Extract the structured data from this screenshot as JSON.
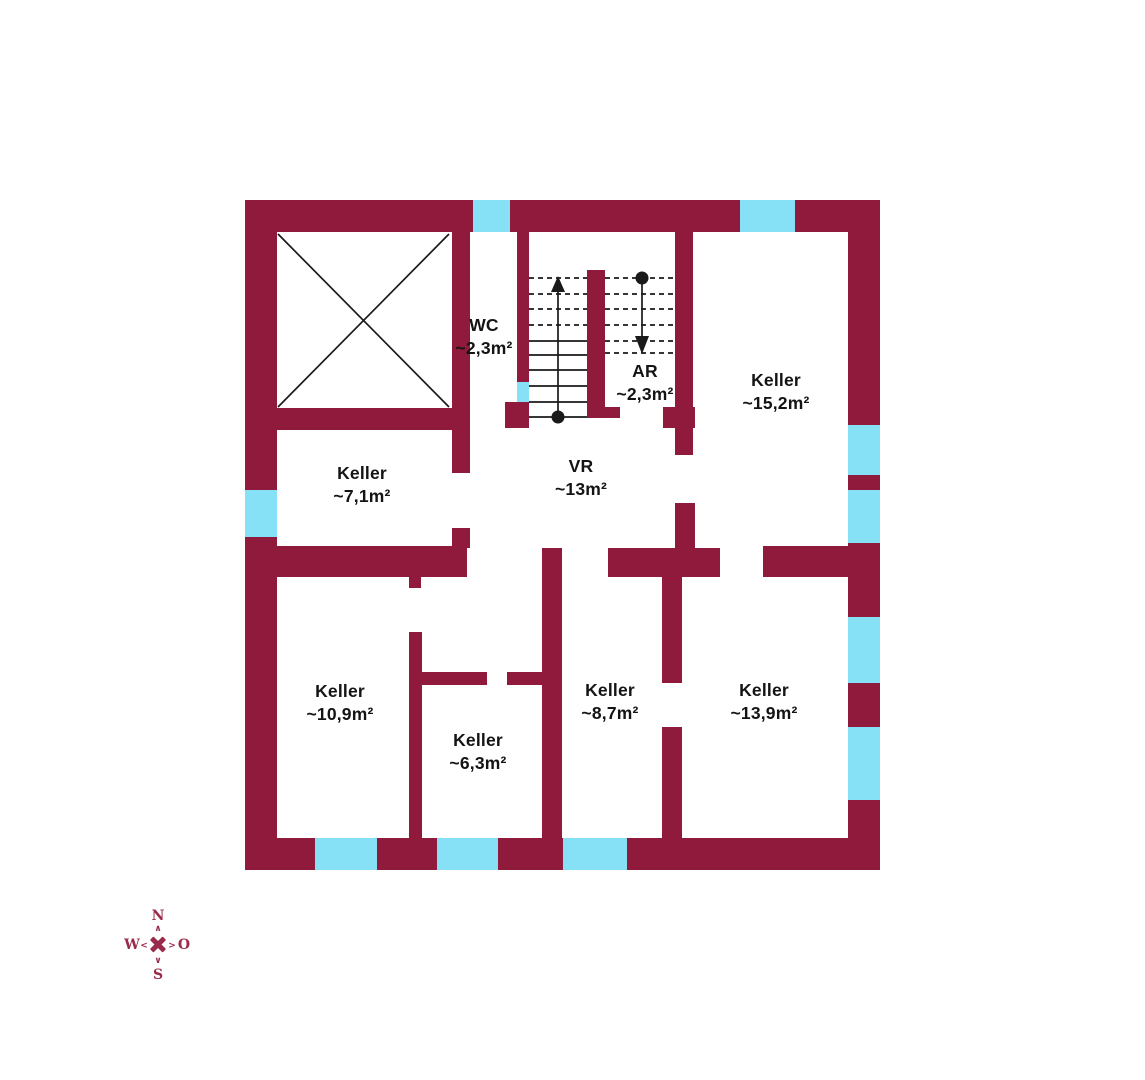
{
  "colors": {
    "wall": "#8f1a3b",
    "window": "#87e1f6",
    "line": "#1a1a1a",
    "compass": "#9b2b4b",
    "background": "#ffffff",
    "text": "#141414"
  },
  "rooms": [
    {
      "id": "wc",
      "name": "WC",
      "area": "~2,3m²",
      "cx": 484,
      "cy": 337
    },
    {
      "id": "ar",
      "name": "AR",
      "area": "~2,3m²",
      "cx": 645,
      "cy": 383
    },
    {
      "id": "keller-152",
      "name": "Keller",
      "area": "~15,2m²",
      "cx": 776,
      "cy": 392
    },
    {
      "id": "keller-71",
      "name": "Keller",
      "area": "~7,1m²",
      "cx": 362,
      "cy": 485
    },
    {
      "id": "vr",
      "name": "VR",
      "area": "~13m²",
      "cx": 581,
      "cy": 478
    },
    {
      "id": "keller-109",
      "name": "Keller",
      "area": "~10,9m²",
      "cx": 340,
      "cy": 703
    },
    {
      "id": "keller-63",
      "name": "Keller",
      "area": "~6,3m²",
      "cx": 478,
      "cy": 752
    },
    {
      "id": "keller-87",
      "name": "Keller",
      "area": "~8,7m²",
      "cx": 610,
      "cy": 702
    },
    {
      "id": "keller-139",
      "name": "Keller",
      "area": "~13,9m²",
      "cx": 764,
      "cy": 702
    }
  ],
  "compass": {
    "north": "N",
    "east": "O",
    "south": "S",
    "west": "W",
    "chevron_up": "∧",
    "chevron_down": "∨",
    "chevron_left": "<",
    "chevron_right": ">"
  },
  "geometry": {
    "walls": [
      [
        245,
        200,
        635,
        32
      ],
      [
        245,
        838,
        635,
        32
      ],
      [
        245,
        200,
        32,
        670
      ],
      [
        848,
        200,
        32,
        670
      ],
      [
        452,
        232,
        18,
        241
      ],
      [
        277,
        408,
        177,
        22
      ],
      [
        452,
        528,
        18,
        20
      ],
      [
        277,
        546,
        190,
        31
      ],
      [
        409,
        577,
        12,
        11
      ],
      [
        409,
        632,
        13,
        206
      ],
      [
        421,
        672,
        66,
        13
      ],
      [
        507,
        672,
        36,
        13
      ],
      [
        542,
        548,
        20,
        290
      ],
      [
        608,
        548,
        112,
        29
      ],
      [
        675,
        503,
        20,
        45
      ],
      [
        662,
        577,
        20,
        106
      ],
      [
        662,
        727,
        20,
        111
      ],
      [
        763,
        546,
        85,
        31
      ],
      [
        517,
        232,
        12,
        150
      ],
      [
        505,
        402,
        24,
        26
      ],
      [
        587,
        270,
        18,
        137
      ],
      [
        587,
        407,
        33,
        11
      ],
      [
        675,
        232,
        18,
        223
      ],
      [
        663,
        407,
        32,
        21
      ]
    ],
    "windows": [
      [
        473,
        200,
        37,
        32
      ],
      [
        740,
        200,
        55,
        32
      ],
      [
        245,
        490,
        32,
        47
      ],
      [
        848,
        425,
        32,
        50
      ],
      [
        848,
        490,
        32,
        53
      ],
      [
        848,
        617,
        32,
        66
      ],
      [
        848,
        727,
        32,
        73
      ],
      [
        315,
        838,
        62,
        32
      ],
      [
        437,
        838,
        61,
        32
      ],
      [
        563,
        838,
        64,
        32
      ],
      [
        517,
        382,
        12,
        20
      ]
    ],
    "elevator_lines": [
      [
        278,
        234,
        449,
        407
      ],
      [
        449,
        234,
        278,
        407
      ]
    ],
    "treads_solid": [
      [
        529,
        341,
        587,
        341
      ],
      [
        529,
        355,
        587,
        355
      ],
      [
        529,
        370,
        587,
        370
      ],
      [
        529,
        386,
        587,
        386
      ],
      [
        529,
        402,
        587,
        402
      ],
      [
        529,
        417,
        587,
        417
      ]
    ],
    "treads_dashed": [
      [
        529,
        278,
        587,
        278
      ],
      [
        529,
        294,
        587,
        294
      ],
      [
        529,
        309,
        587,
        309
      ],
      [
        529,
        325,
        587,
        325
      ],
      [
        605,
        278,
        675,
        278
      ],
      [
        605,
        294,
        675,
        294
      ],
      [
        605,
        309,
        675,
        309
      ],
      [
        605,
        325,
        675,
        325
      ],
      [
        605,
        341,
        675,
        341
      ],
      [
        605,
        353,
        675,
        353
      ]
    ],
    "arrows": [
      {
        "x": 558,
        "line_y1": 417,
        "line_y2": 288,
        "tip_y": 276,
        "base_y": 292,
        "dot_y": 417
      },
      {
        "x": 642,
        "line_y1": 278,
        "line_y2": 338,
        "tip_y": 354,
        "base_y": 336,
        "dot_y": 278
      }
    ]
  }
}
